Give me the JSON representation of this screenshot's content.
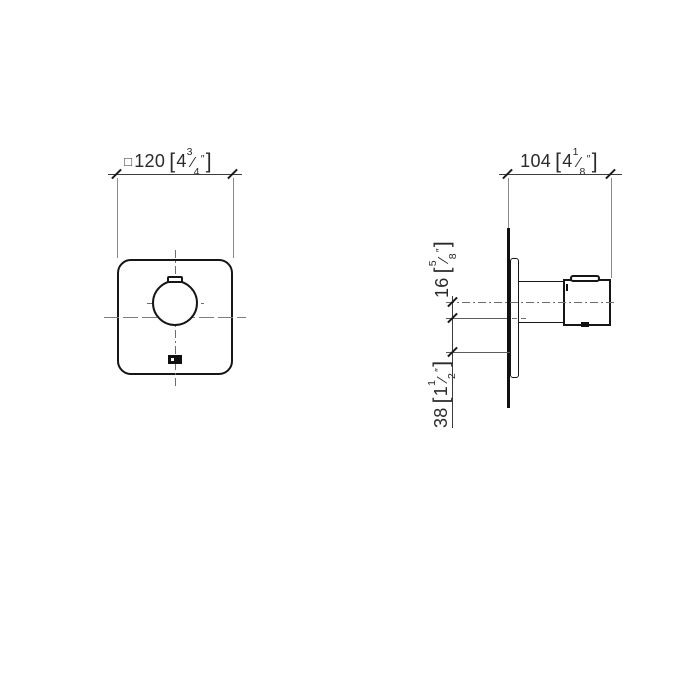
{
  "symbols": {
    "square": "□",
    "lbracket": "[",
    "rbracket": "]",
    "inch_mark": "″",
    "fraction_slash": "⁄"
  },
  "dimensions": {
    "front_width": {
      "mm": "120",
      "inch_whole": "4",
      "frac_num": "3",
      "frac_den": "4"
    },
    "side_depth": {
      "mm": "104",
      "inch_whole": "4",
      "frac_num": "1",
      "frac_den": "8"
    },
    "offset_upper": {
      "mm": "16",
      "inch_whole": "",
      "frac_num": "5",
      "frac_den": "8"
    },
    "offset_lower": {
      "mm": "38",
      "inch_whole": "1",
      "frac_num": "1",
      "frac_den": "2"
    }
  },
  "colors": {
    "background": "#ffffff",
    "outline": "#161616",
    "dimension_line": "#3c3c3c",
    "extension_line": "#8a8a8a",
    "centerline": "#6e6e6e",
    "marker_fill": "#101010"
  }
}
